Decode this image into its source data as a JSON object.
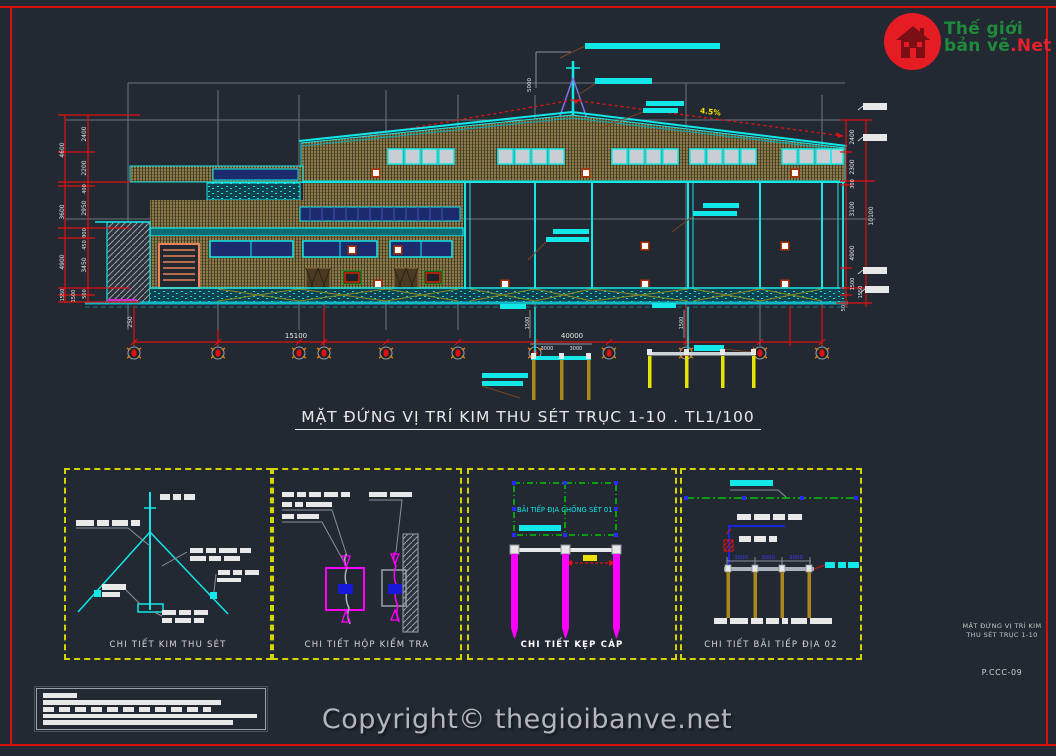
{
  "logo": {
    "line1": "Thế giới",
    "line2": "bản vẽ",
    "suffix": ".Net"
  },
  "main_title": "MẶT ĐỨNG VỊ TRÍ KIM THU SÉT TRỤC 1-10 . TL1/100",
  "elevation": {
    "slope_label": "4.5%",
    "mast_height_dim": "5000",
    "span_left": "15100",
    "span_right": "40000",
    "dim_250": "250",
    "left_outer_dims": [
      "4600",
      "3600",
      "4900",
      "1550"
    ],
    "left_inner_dims": [
      "2400",
      "2200",
      "400",
      "2950",
      "900",
      "450",
      "3450",
      "500",
      "1500"
    ],
    "right_inner_dims": [
      "2400",
      "2300",
      "300",
      "3100",
      "4900",
      "1500"
    ],
    "right_outer_dims": [
      "10100",
      "1550",
      "50"
    ],
    "ground_rod_dims": [
      "3000",
      "3000"
    ],
    "ground_rod_vdims": [
      "1500",
      "1500"
    ]
  },
  "panels": {
    "p1": {
      "caption": "CHI TIẾT KIM THU SÉT"
    },
    "p2": {
      "caption": "CHI TIẾT HỘP KIỂM TRA"
    },
    "p3": {
      "caption": "CHI TIẾT KẸP CÁP",
      "area_label": "BÃI TIẾP ĐỊA CHỐNG SÉT 01"
    },
    "p4": {
      "caption": "CHI TIẾT BÃI TIẾP ĐỊA 02",
      "dims": [
        "3000",
        "3000",
        "3000"
      ]
    }
  },
  "sheet": {
    "line1": "MẶT ĐỨNG VỊ TRÍ KIM",
    "line2": "THU SÉT TRỤC 1-10",
    "code": "P.CCC-09"
  },
  "footer": {
    "copyright": "Copyright© thegioibanve.net"
  },
  "colors": {
    "accent_cyan": "#12e8e8",
    "frame_red": "#d80f0f",
    "wall_khaki": "#8d7c4a",
    "magenta": "#ff00ff",
    "detail_yellow": "#d6d400",
    "logo_red": "#e51c23",
    "logo_green": "#1f8a3b"
  }
}
